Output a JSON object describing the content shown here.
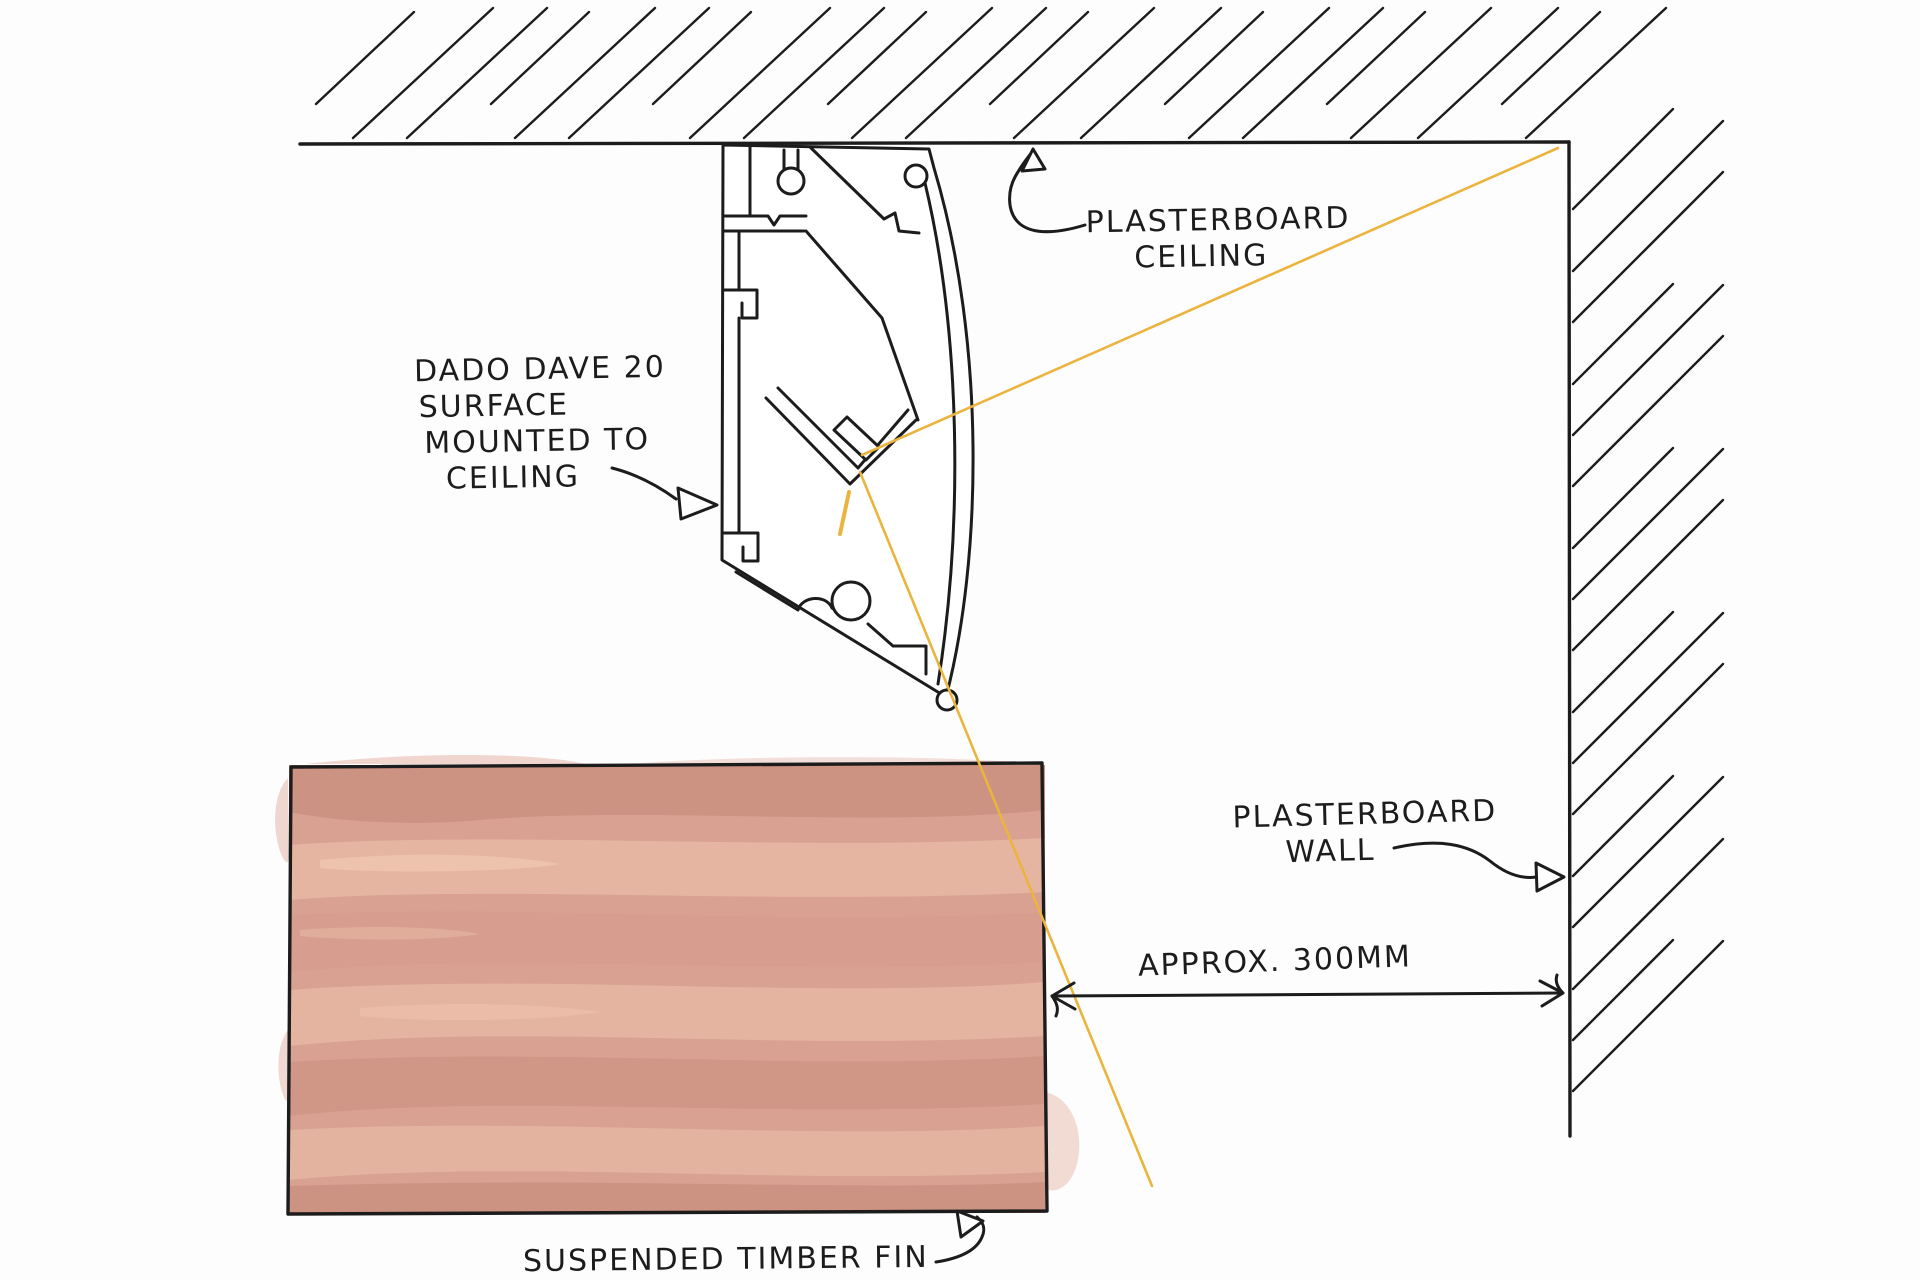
{
  "title": "Hand sketch — Dado Dave 20 surface mounted ceiling detail",
  "labels": {
    "profile_label": {
      "line1": "DADO DAVE 20",
      "line2": "SURFACE",
      "line3": "MOUNTED TO",
      "line4": "CEILING"
    },
    "ceiling_label": {
      "line1": "PLASTERBOARD",
      "line2": "CEILING"
    },
    "wall_label": {
      "line1": "PLASTERBOARD",
      "line2": "WALL"
    },
    "dimension_label": "APPROX. 300MM",
    "fin_label": "SUSPENDED TIMBER FIN"
  },
  "colors": {
    "ink": "#1c1c1c",
    "ray": "#eab43e",
    "fin_base": "#d9a191",
    "fin_light": "#e7b9a4",
    "fin_dark": "#c88e7e",
    "paper": "#fdfdfd"
  }
}
